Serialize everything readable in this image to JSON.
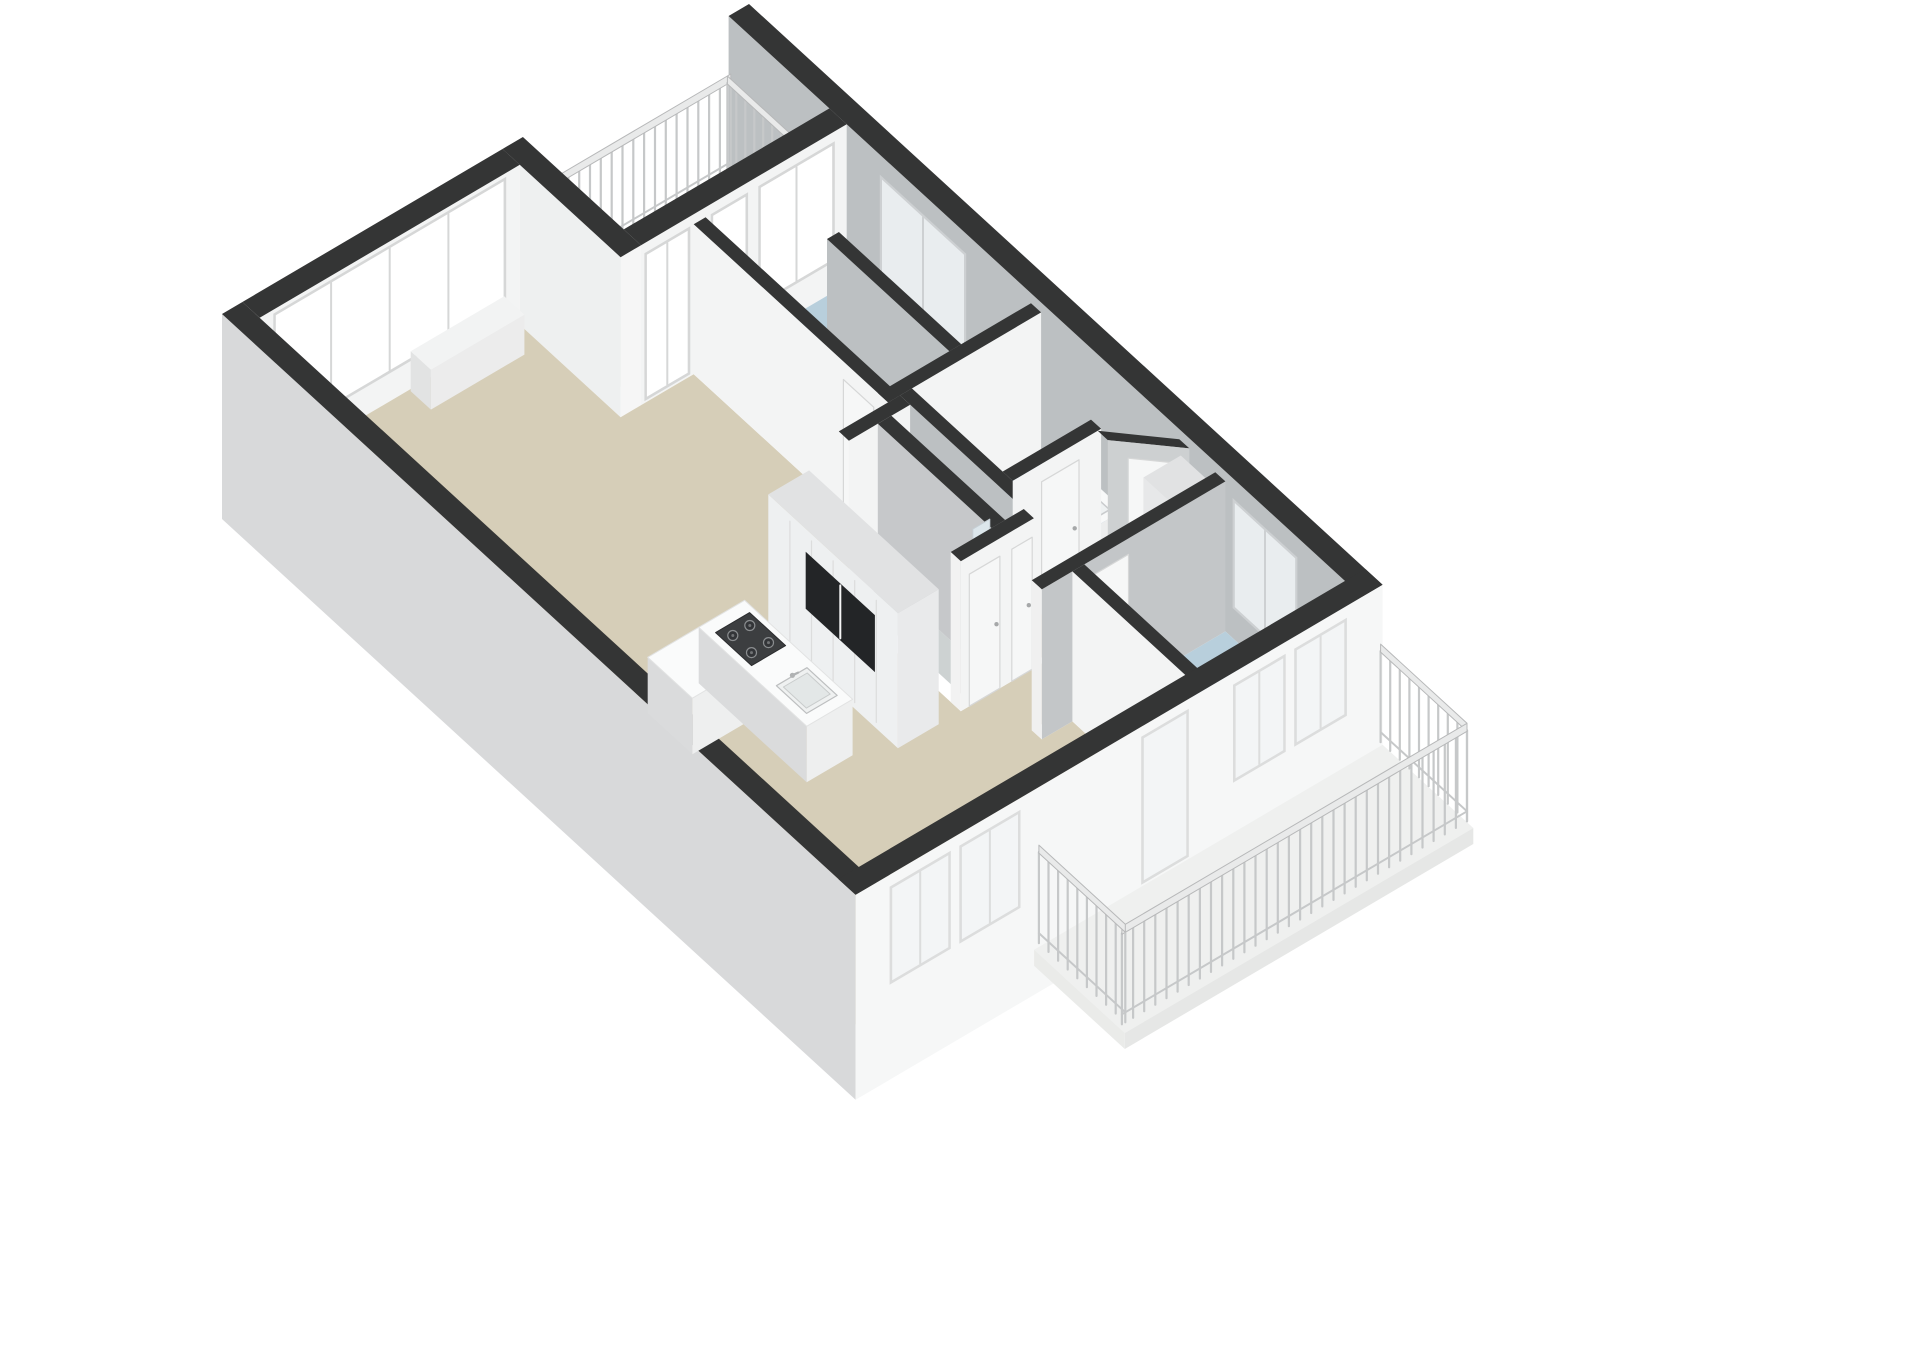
{
  "scene": {
    "description": "3D isometric floor plan rendering of an apartment, viewed from above at an angle on a white background",
    "background": "#ffffff"
  },
  "colors": {
    "wall_top": "#343535",
    "wall_face_white": "#f3f4f4",
    "wall_face_gray": "#bcc0c2",
    "wall_face_light": "#eef0f0",
    "wall_outer_left": "#d8d9da",
    "wall_outer_bottom": "#f6f7f7",
    "floor_living": "#d6ceb8",
    "floor_bedroom": "#b8cfdc",
    "floor_bathroom": "#8ca5c3",
    "floor_shower": "#aec7d8",
    "floor_wc": "#cdd2d2",
    "floor_balcony_nw": "#e7e8e6",
    "floor_balcony_se": "#eff0ef",
    "glass_white": "#ffffff",
    "glass_gray": "#e9edef",
    "glass_outer": "#f3f5f6",
    "frame": "#d6d7d7",
    "frame_gray": "#cdd0d2",
    "railing": "#c6c8c9",
    "railing_top": "#e9eaea",
    "cabinet_face": "#eef0f1",
    "cabinet_top": "#e1e2e3",
    "cabinet_end": "#e9eaeb",
    "appliance_dark": "#232527",
    "island_top": "#fafbfb",
    "island_face_sw": "#dadbdc",
    "island_face_se": "#eeefef",
    "hob": "#3c3e40",
    "burner": "#333538",
    "burner_ring": "#8a8d8f",
    "fixture_white": "#fdfdfd",
    "fixture_stroke": "#c7c9ca",
    "door_panel": "#f6f7f7",
    "door_leaf": "#fbfbfb",
    "shower_glass": "#dce6eb"
  },
  "features": {
    "bedrooms": 2,
    "bathrooms_with_tub": 1,
    "shower_rooms": 1,
    "wc_with_toilet": 1,
    "balconies_with_railing": 2,
    "kitchen_island": 1,
    "cooktop_burners": 4,
    "kitchen_sink": 1,
    "tall_cabinet_walls": 2,
    "window_bands": 3
  }
}
